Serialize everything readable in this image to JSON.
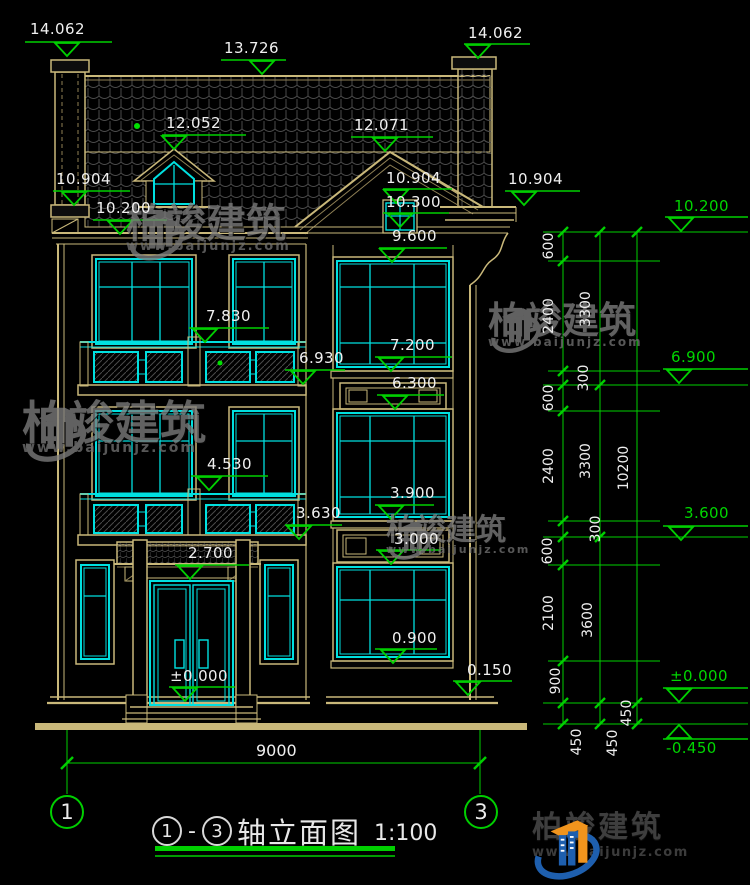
{
  "colors": {
    "background": "#000000",
    "cad_tan": "#c9b87a",
    "cad_cyan": "#00e0e0",
    "dim_green": "#00cf00",
    "text_white": "#f0f0f0",
    "hatch_gray": "#4a4a4a",
    "watermark_gray": "#7d7d7d",
    "logo_blue": "#1e5fae",
    "logo_orange": "#f0941d"
  },
  "watermark": {
    "brand": "柏竣建筑",
    "url": "www.baijunjz.com"
  },
  "logo": {
    "brand": "柏竣建筑",
    "url": "www.baijunjz.com"
  },
  "title_block": {
    "axis_start": "1",
    "separator": "-",
    "axis_end": "3",
    "name": "轴立面图",
    "scale": "1:100"
  },
  "axes": [
    {
      "label": "1"
    },
    {
      "label": "3"
    }
  ],
  "overall_dim": "9000",
  "elevation_markers": [
    {
      "v": "14.062",
      "x": 30,
      "y": 22,
      "ly": 42,
      "lx1": 25,
      "lx2": 112,
      "ax": 67,
      "dir": "d",
      "c": "w"
    },
    {
      "v": "13.726",
      "x": 224,
      "y": 41,
      "ly": 60,
      "lx1": 221,
      "lx2": 286,
      "ax": 262,
      "dir": "d",
      "c": "w"
    },
    {
      "v": "14.062",
      "x": 468,
      "y": 26,
      "ly": 44,
      "lx1": 464,
      "lx2": 530,
      "ax": 478,
      "dir": "d",
      "c": "w"
    },
    {
      "v": "12.052",
      "x": 166,
      "y": 116,
      "ly": 135,
      "lx1": 162,
      "lx2": 246,
      "ax": 174,
      "dir": "d",
      "c": "w"
    },
    {
      "v": "12.071",
      "x": 354,
      "y": 118,
      "ly": 137,
      "lx1": 351,
      "lx2": 433,
      "ax": 385,
      "dir": "d",
      "c": "w"
    },
    {
      "v": "10.904",
      "x": 56,
      "y": 172,
      "ly": 191,
      "lx1": 53,
      "lx2": 130,
      "ax": 74,
      "dir": "d",
      "c": "w"
    },
    {
      "v": "10.200",
      "x": 96,
      "y": 201,
      "ly": 220,
      "lx1": 93,
      "lx2": 167,
      "ax": 120,
      "dir": "d",
      "c": "w"
    },
    {
      "v": "10.904",
      "x": 386,
      "y": 171,
      "ly": 189,
      "lx1": 383,
      "lx2": 452,
      "ax": 396,
      "dir": "d",
      "c": "w"
    },
    {
      "v": "10.300",
      "x": 386,
      "y": 195,
      "ly": 213,
      "lx1": 383,
      "lx2": 449,
      "ax": 400,
      "dir": "d",
      "c": "w"
    },
    {
      "v": "9.600",
      "x": 392,
      "y": 229,
      "ly": 248,
      "lx1": 379,
      "lx2": 447,
      "ax": 392,
      "dir": "d",
      "c": "w"
    },
    {
      "v": "10.904",
      "x": 508,
      "y": 172,
      "ly": 191,
      "lx1": 505,
      "lx2": 580,
      "ax": 524,
      "dir": "d",
      "c": "w"
    },
    {
      "v": "7.830",
      "x": 206,
      "y": 309,
      "ly": 328,
      "lx1": 189,
      "lx2": 269,
      "ax": 205,
      "dir": "d",
      "c": "w"
    },
    {
      "v": "7.200",
      "x": 390,
      "y": 338,
      "ly": 357,
      "lx1": 375,
      "lx2": 452,
      "ax": 391,
      "dir": "d",
      "c": "w"
    },
    {
      "v": "6.930",
      "x": 299,
      "y": 351,
      "ly": 370,
      "lx1": 285,
      "lx2": 345,
      "ax": 303,
      "dir": "d",
      "c": "w"
    },
    {
      "v": "6.300",
      "x": 392,
      "y": 376,
      "ly": 395,
      "lx1": 377,
      "lx2": 444,
      "ax": 395,
      "dir": "d",
      "c": "w"
    },
    {
      "v": "4.530",
      "x": 207,
      "y": 457,
      "ly": 476,
      "lx1": 191,
      "lx2": 268,
      "ax": 209,
      "dir": "d",
      "c": "w"
    },
    {
      "v": "3.900",
      "x": 390,
      "y": 486,
      "ly": 505,
      "lx1": 375,
      "lx2": 434,
      "ax": 391,
      "dir": "d",
      "c": "w"
    },
    {
      "v": "3.630",
      "x": 296,
      "y": 506,
      "ly": 525,
      "lx1": 285,
      "lx2": 342,
      "ax": 299,
      "dir": "d",
      "c": "w"
    },
    {
      "v": "3.000",
      "x": 394,
      "y": 532,
      "ly": 550,
      "lx1": 376,
      "lx2": 441,
      "ax": 391,
      "dir": "d",
      "c": "w"
    },
    {
      "v": "2.700",
      "x": 188,
      "y": 546,
      "ly": 565,
      "lx1": 175,
      "lx2": 249,
      "ax": 190,
      "dir": "d",
      "c": "w"
    },
    {
      "v": "0.900",
      "x": 392,
      "y": 631,
      "ly": 649,
      "lx1": 375,
      "lx2": 437,
      "ax": 393,
      "dir": "d",
      "c": "w"
    },
    {
      "v": "0.150",
      "x": 467,
      "y": 663,
      "ly": 681,
      "lx1": 453,
      "lx2": 512,
      "ax": 468,
      "dir": "d",
      "c": "w"
    },
    {
      "v": "±0.000",
      "x": 170,
      "y": 669,
      "ly": 687,
      "lx1": 169,
      "lx2": 235,
      "ax": 185,
      "dir": "d",
      "c": "w"
    },
    {
      "v": "10.200",
      "x": 674,
      "y": 199,
      "ly": 217,
      "lx1": 665,
      "lx2": 748,
      "ax": 681,
      "dir": "d",
      "c": "g"
    },
    {
      "v": "6.900",
      "x": 671,
      "y": 350,
      "ly": 369,
      "lx1": 663,
      "lx2": 748,
      "ax": 679,
      "dir": "d",
      "c": "g"
    },
    {
      "v": "3.600",
      "x": 684,
      "y": 506,
      "ly": 526,
      "lx1": 663,
      "lx2": 748,
      "ax": 681,
      "dir": "d",
      "c": "g"
    },
    {
      "v": "±0.000",
      "x": 670,
      "y": 669,
      "ly": 688,
      "lx1": 663,
      "lx2": 748,
      "ax": 679,
      "dir": "d",
      "c": "g"
    },
    {
      "v": "-0.450",
      "x": 666,
      "y": 741,
      "ly": 739,
      "lx1": 663,
      "lx2": 748,
      "ax": 679,
      "dir": "u",
      "c": "g"
    }
  ],
  "dim_labels": [
    {
      "v": "600",
      "x": 549,
      "y": 246
    },
    {
      "v": "2400",
      "x": 549,
      "y": 316
    },
    {
      "v": "300",
      "x": 584,
      "y": 378
    },
    {
      "v": "600",
      "x": 549,
      "y": 398
    },
    {
      "v": "2400",
      "x": 549,
      "y": 466
    },
    {
      "v": "300",
      "x": 596,
      "y": 529
    },
    {
      "v": "600",
      "x": 548,
      "y": 551
    },
    {
      "v": "2100",
      "x": 549,
      "y": 613
    },
    {
      "v": "900",
      "x": 556,
      "y": 681
    },
    {
      "v": "450",
      "x": 577,
      "y": 742
    },
    {
      "v": "3300",
      "x": 586,
      "y": 309
    },
    {
      "v": "3300",
      "x": 586,
      "y": 461
    },
    {
      "v": "3600",
      "x": 588,
      "y": 620
    },
    {
      "v": "450",
      "x": 613,
      "y": 743
    },
    {
      "v": "10200",
      "x": 624,
      "y": 468
    },
    {
      "v": "450",
      "x": 627,
      "y": 713
    }
  ]
}
